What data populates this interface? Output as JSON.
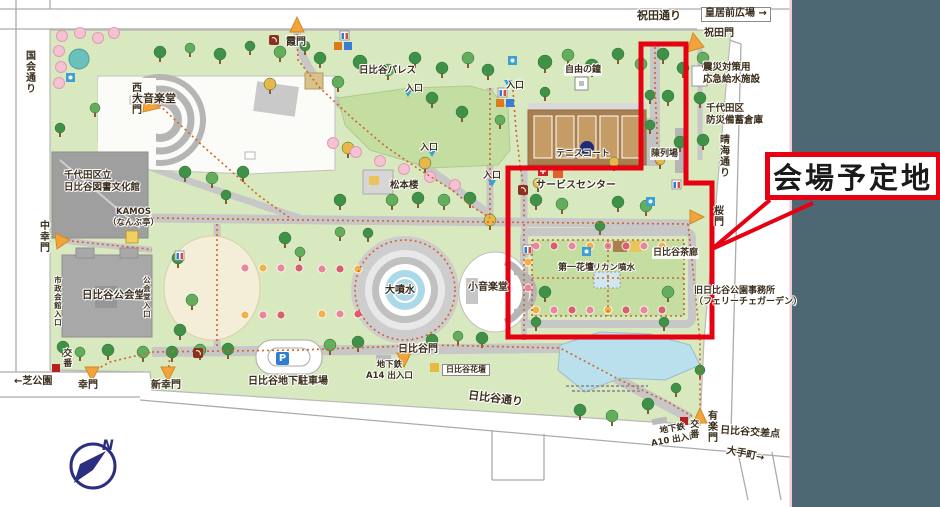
{
  "callout": {
    "text": "会場予定地"
  },
  "compass": {
    "north": "N"
  },
  "labels": {
    "iwaida_dori": "祝田通り",
    "kokyomae_hiroba": "皇居前広場 →",
    "iwaida_mon": "祝田門",
    "kyusui_shisetsu": "震災対策用\n応急給水施設",
    "bichiku_soko": "千代田区\n防災備蓄倉庫",
    "harumi_dori": "晴海通り",
    "sakura_mon": "桜門",
    "chinretsujo": "陳列場",
    "hibiya_saro": "日比谷茶廊",
    "kyu_koen_jimusho": "旧日比谷公園事務所\n（フェリーチェガーデン）",
    "pelican_funsui": "ペリカン噴水",
    "daiichi_kadan": "第一花壇",
    "service_center": "サービスセンター",
    "tennis_court": "テニスコート",
    "jiyu_no_kane": "自由の鐘",
    "entrance": "入口",
    "hibiya_palace": "日比谷パレス",
    "kasumi_mon": "霞門",
    "nishi_saiwai_mon": "西幸門",
    "dai_ongakudo": "大音楽堂",
    "kokkai_dori": "国会通り",
    "library": "千代田区立\n日比谷図書文化館",
    "naka_saiwai_mon": "中幸門",
    "kamos": "KAMOS\n（なんぶ亭）",
    "matsumotoro": "松本楼",
    "kokaido": "日比谷公会堂",
    "shisei_kaikan_iriguchi": "市政会館入口",
    "kokaido_iriguchi": "公会堂入口",
    "dai_funsui": "大噴水",
    "sho_ongakudo": "小音楽堂",
    "koban": "交番",
    "shiba_koen": "←芝公園",
    "saiwai_mon": "幸門",
    "shin_saiwai_mon": "新幸門",
    "chika_parking": "日比谷地下駐車場",
    "metro_a14": "地下鉄\nA14 出入口",
    "hibiya_mon": "日比谷門",
    "hibiya_kadan": "日比谷花壇",
    "hibiya_dori": "日比谷通り",
    "metro_a10": "地下鉄\nA10 出入口",
    "yuraku_mon": "有楽門",
    "hibiya_kosaten": "日比谷交差点",
    "otemachi": "大手町→",
    "parking_p": "P"
  },
  "colors": {
    "venue_red": "#e60012",
    "side_band": "#4d6873",
    "park_green": "#d8e8bf",
    "lawn_green": "#c3dea0",
    "water_blue": "#b9e0ec",
    "path_gray": "#c7c7c7",
    "building_gray": "#a8a8a8",
    "court_brown": "#a97f50",
    "gate_orange": "#f2a33c",
    "trail_orange": "#d4622a",
    "compass_navy": "#2a2f80",
    "flowerbed_cream": "#f4eed8"
  }
}
